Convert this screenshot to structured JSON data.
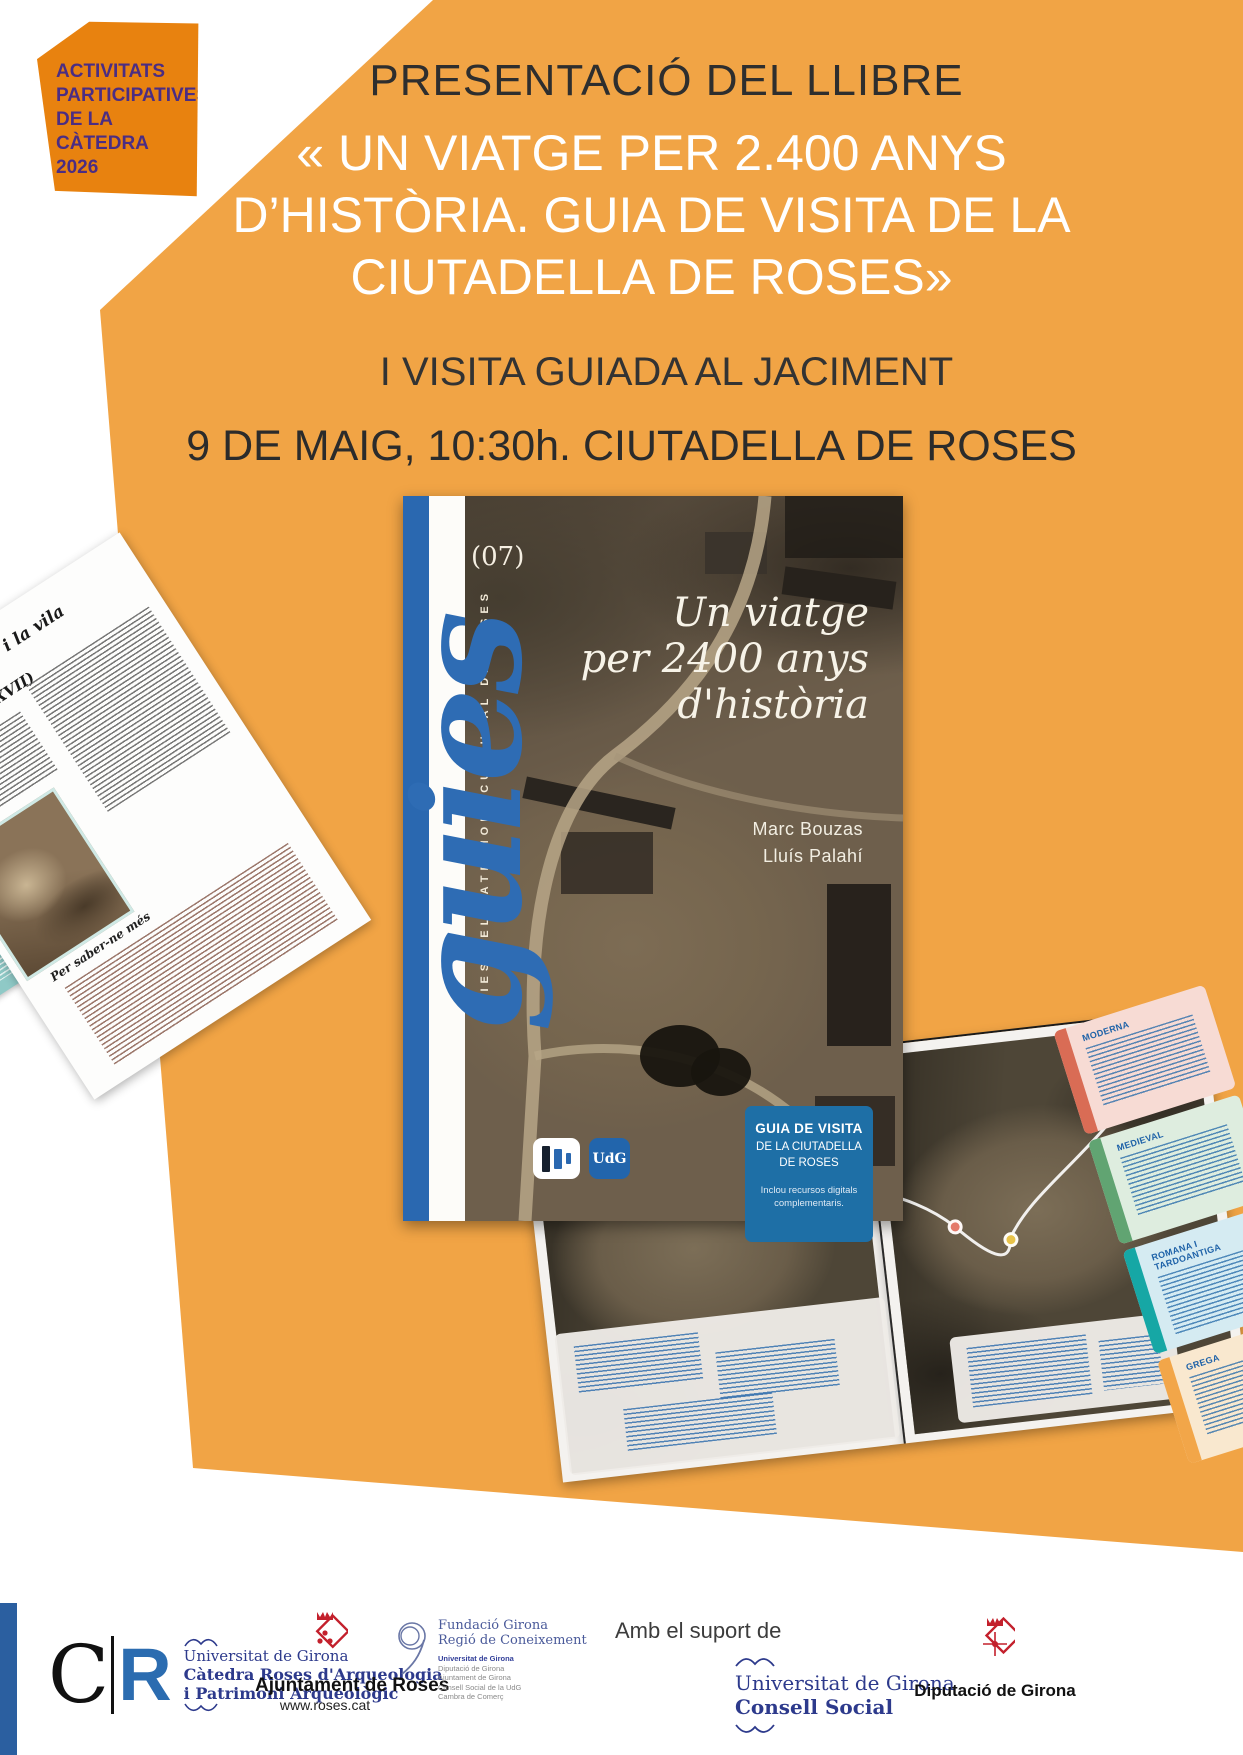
{
  "badge": {
    "lines": [
      "ACTIVITATS",
      "PARTICIPATIVES",
      "DE LA CÀTEDRA",
      "2026"
    ]
  },
  "header": {
    "kicker": "PRESENTACIÓ DEL LLIBRE",
    "title_line1": "« UN  VIATGE PER 2.400 ANYS",
    "title_line2": "D’HISTÒRIA. GUIA DE VISITA DE LA",
    "title_line3": "CIUTADELLA  DE ROSES»",
    "subtitle": "I VISITA GUIADA AL JACIMENT",
    "datetime": "9 DE MAIG, 10:30h. CIUTADELLA DE ROSES"
  },
  "book_cover": {
    "series_number": "(07)",
    "series_script": "guies",
    "series_caption": "GUIES DEL PATRIMONI CULTURAL DE ROSES",
    "title_line1": "Un viatge",
    "title_line2": "per 2400 anys",
    "title_line3": "d'història",
    "author1": "Marc Bouzas",
    "author2": "Lluís Palahí",
    "info_box": {
      "heading_line1": "GUIA DE VISITA",
      "heading_line2": "DE LA CIUTADELLA",
      "heading_line3": "DE ROSES",
      "note_line1": "Inclou recursos digitals",
      "note_line2": "complementaris."
    },
    "udg_logo_text": "UdG"
  },
  "left_page": {
    "heading": "El monestir i la vila medieval",
    "heading_sub": "(segles X-XVII)",
    "more_label": "Per saber-ne més"
  },
  "map_spread": {
    "timeline": [
      {
        "label": "MODERNA"
      },
      {
        "label": "MEDIEVAL"
      },
      {
        "label": "ROMANA I TARDOANTIGA"
      },
      {
        "label": "GREGA"
      }
    ]
  },
  "footer": {
    "cr_logo": {
      "c": "C",
      "r": "R",
      "line1": "Universitat de Girona",
      "line2": "Càtedra Roses d'Arqueologia",
      "line3": "i Patrimoni Arqueològic"
    },
    "roses": {
      "name": "Ajuntament de Roses",
      "url": "www.roses.cat"
    },
    "fundacio": {
      "name_line1": "Fundació Girona",
      "name_line2": "Regió de Coneixement",
      "partner1": "Universitat de Girona",
      "partner2": "Diputació de Girona",
      "partner3": "Ajuntament de Girona",
      "partner4": "Consell Social de la UdG",
      "partner5": "Cambra de Comerç"
    },
    "support_label": "Amb el suport de",
    "consell": {
      "line1": "Universitat de Girona",
      "line2": "Consell Social"
    },
    "diputacio": {
      "name": "Diputació de Girona"
    }
  },
  "colors": {
    "background_orange": "#F1A445",
    "badge_orange": "#E8820F",
    "badge_text_purple": "#4B2D83",
    "cover_blue": "#2A68B0",
    "infobox_blue": "#1E6FA6",
    "timeline_moderna": "#D96C55",
    "timeline_medieval": "#61A472",
    "timeline_romana": "#16A7A5",
    "timeline_grega": "#F2A649",
    "legend_text_blue": "#1E62A8"
  }
}
